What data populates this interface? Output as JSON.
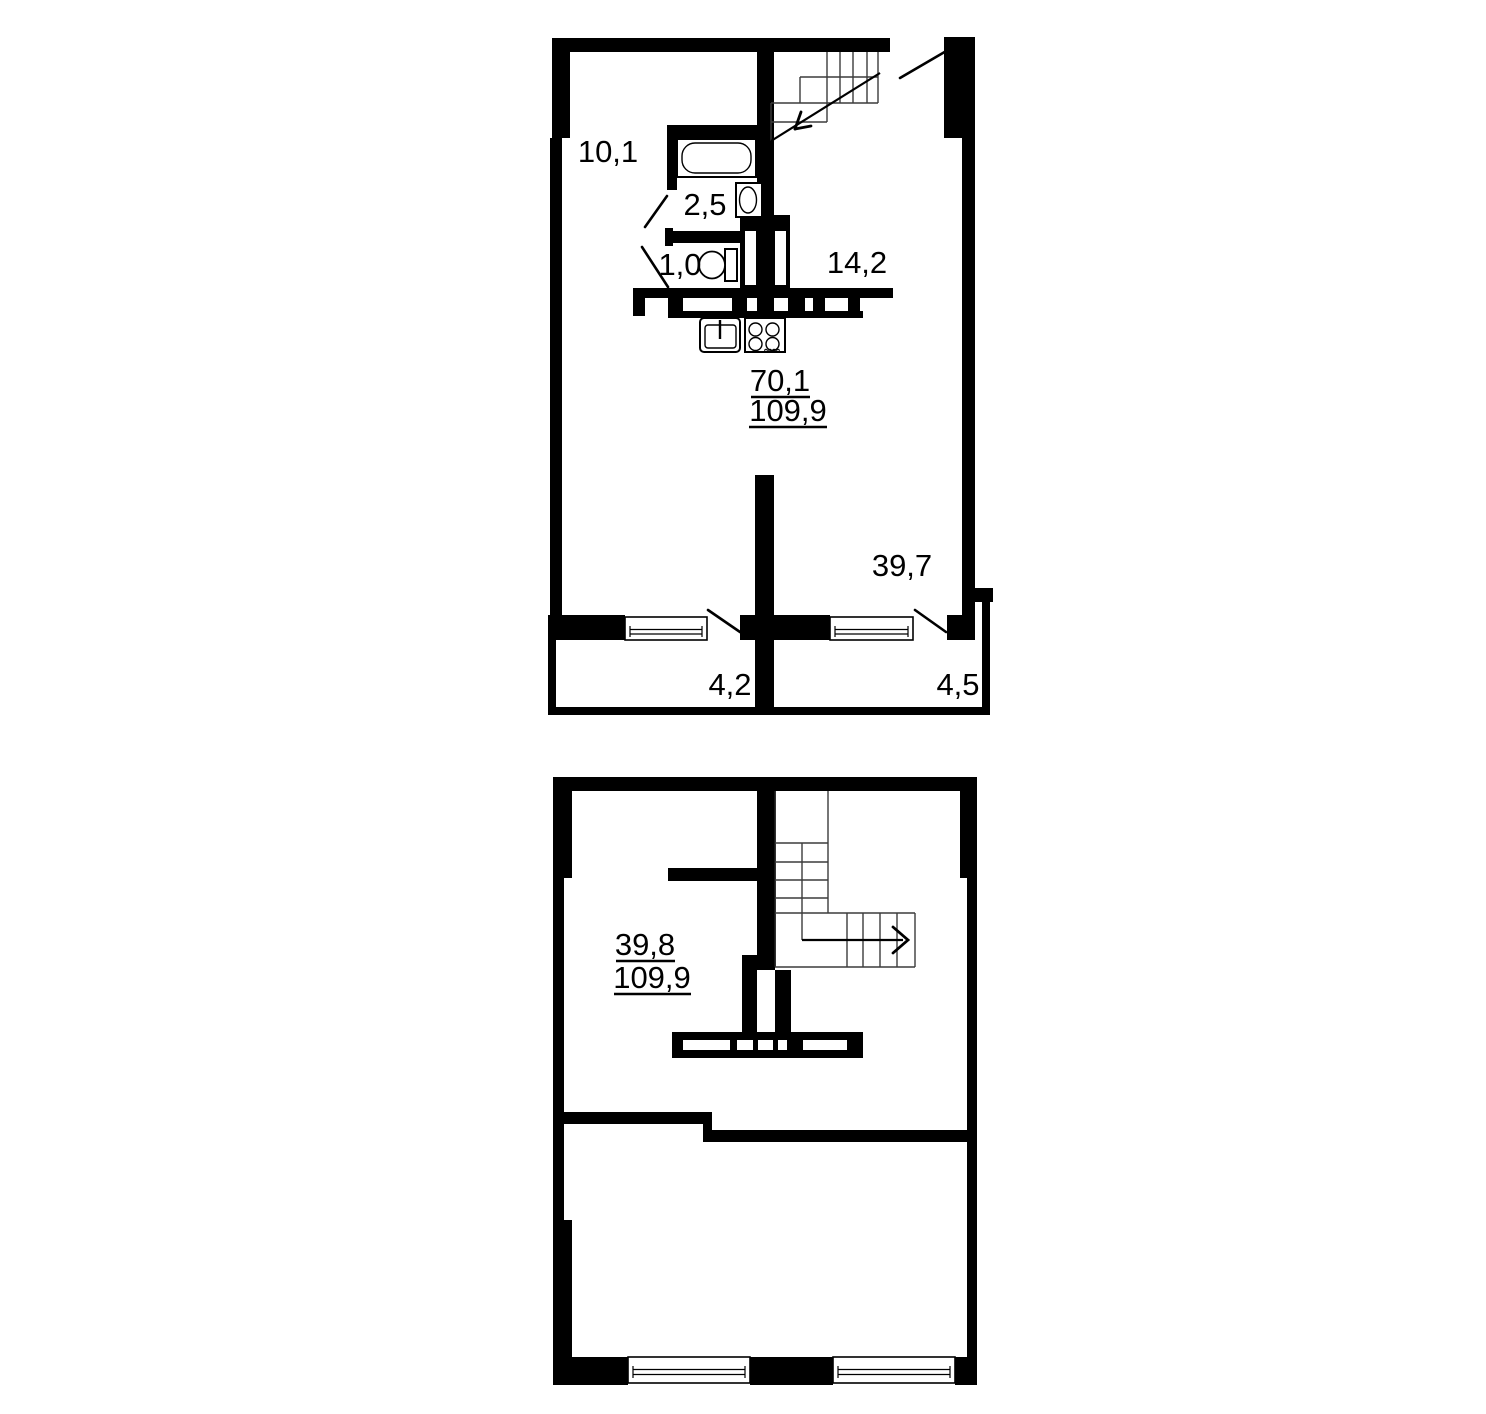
{
  "plans": {
    "upper": {
      "rooms": {
        "room_top_left": "10,1",
        "bathroom": "2,5",
        "wc": "1,0",
        "room_right": "14,2",
        "room_bottom": "39,7",
        "balcony_left": "4,2",
        "balcony_right": "4,5"
      },
      "area_note": {
        "living": "70,1",
        "total": "109,9"
      }
    },
    "lower": {
      "area_note": {
        "living": "39,8",
        "total": "109,9"
      }
    }
  },
  "colors": {
    "walls": "#000000",
    "background": "#ffffff",
    "stair_lines": "#3c3c3c"
  }
}
